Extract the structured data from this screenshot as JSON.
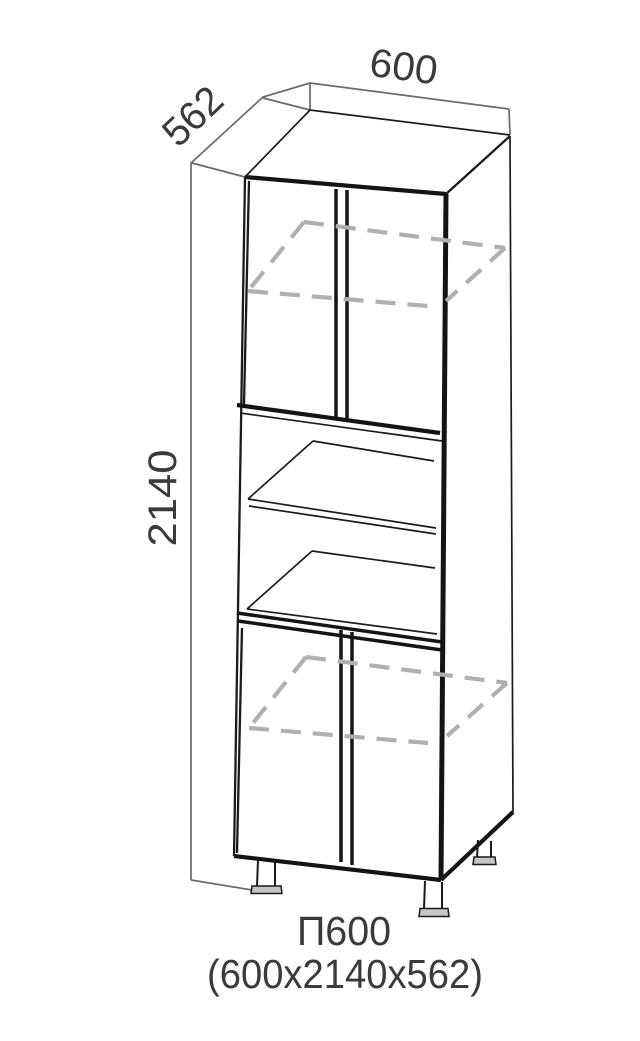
{
  "drawing": {
    "type": "furniture-cabinet-technical-drawing",
    "product_code": "П600",
    "size_label": "(600x2140x562)",
    "dim_width": "600",
    "dim_depth": "562",
    "dim_height": "2140"
  },
  "colors": {
    "background": "#ffffff",
    "main_lines": "#1b1b1b",
    "hidden_lines": "#b0b0b0",
    "dimension_lines": "#6a6a6a",
    "text": "#3a3a3a",
    "leg_foot_fill": "#c6c6c6"
  }
}
